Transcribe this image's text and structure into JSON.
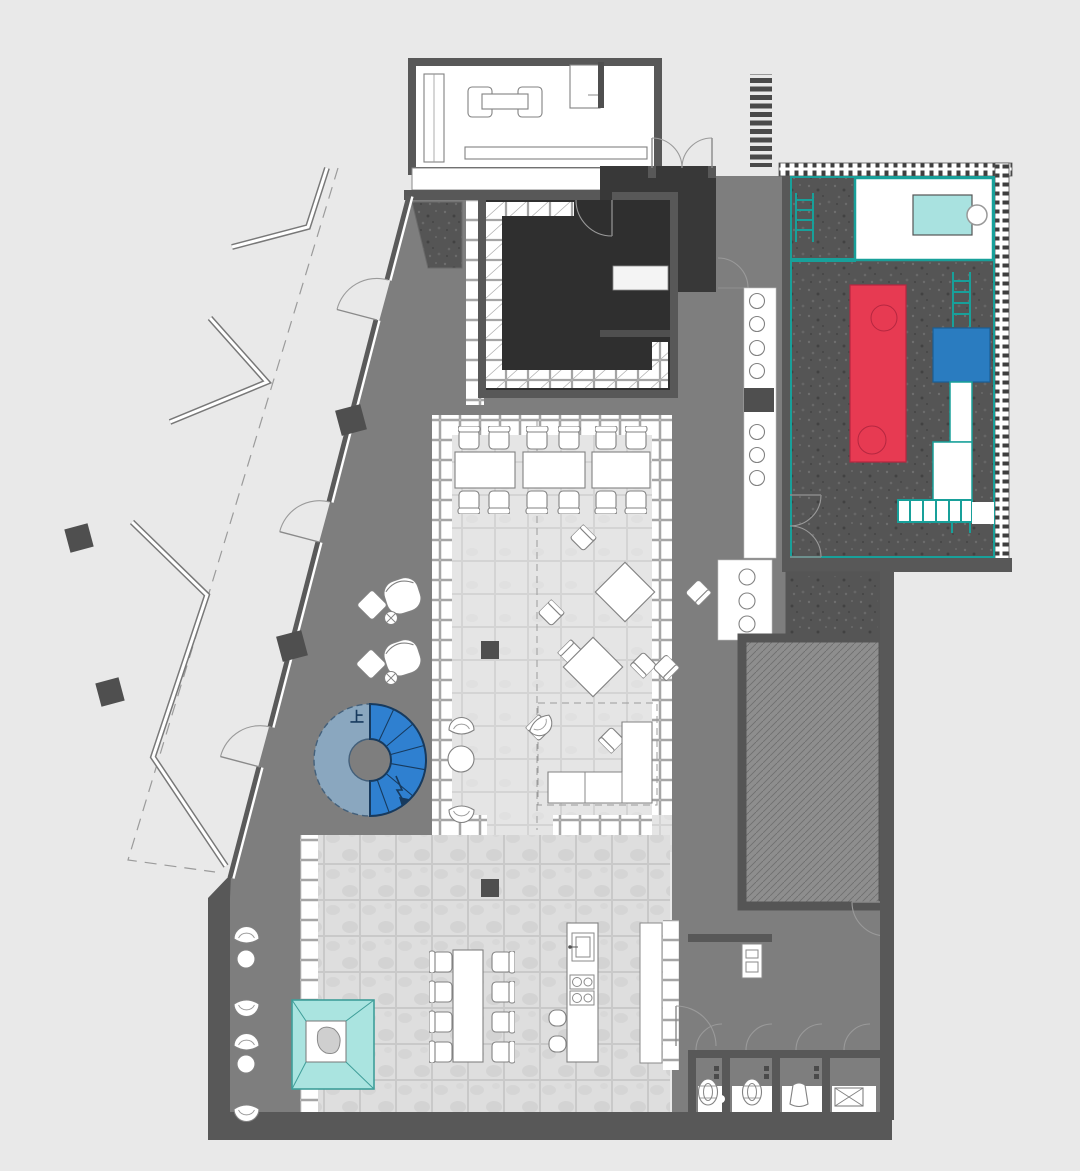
{
  "plan": {
    "stair": {
      "label": "上"
    },
    "colors": {
      "background": "#e9e9e9",
      "wall": "#585858",
      "floor_gray": "#7e7e7e",
      "dark_room": "#2f2f2f",
      "play_floor": "#555555",
      "teal": "#18a09a",
      "light_cyan": "#a9e2e0",
      "pavilion": "#aae4e0",
      "red": "#e73a52",
      "red_outline": "#b52740",
      "blue": "#2a7cc0",
      "stair_up": "#2f80d0",
      "stair_ring": "#8aa7bf",
      "tile_white": "#ffffff",
      "marble": "#dddddd",
      "dining_tile": "#e5e5e5"
    }
  }
}
